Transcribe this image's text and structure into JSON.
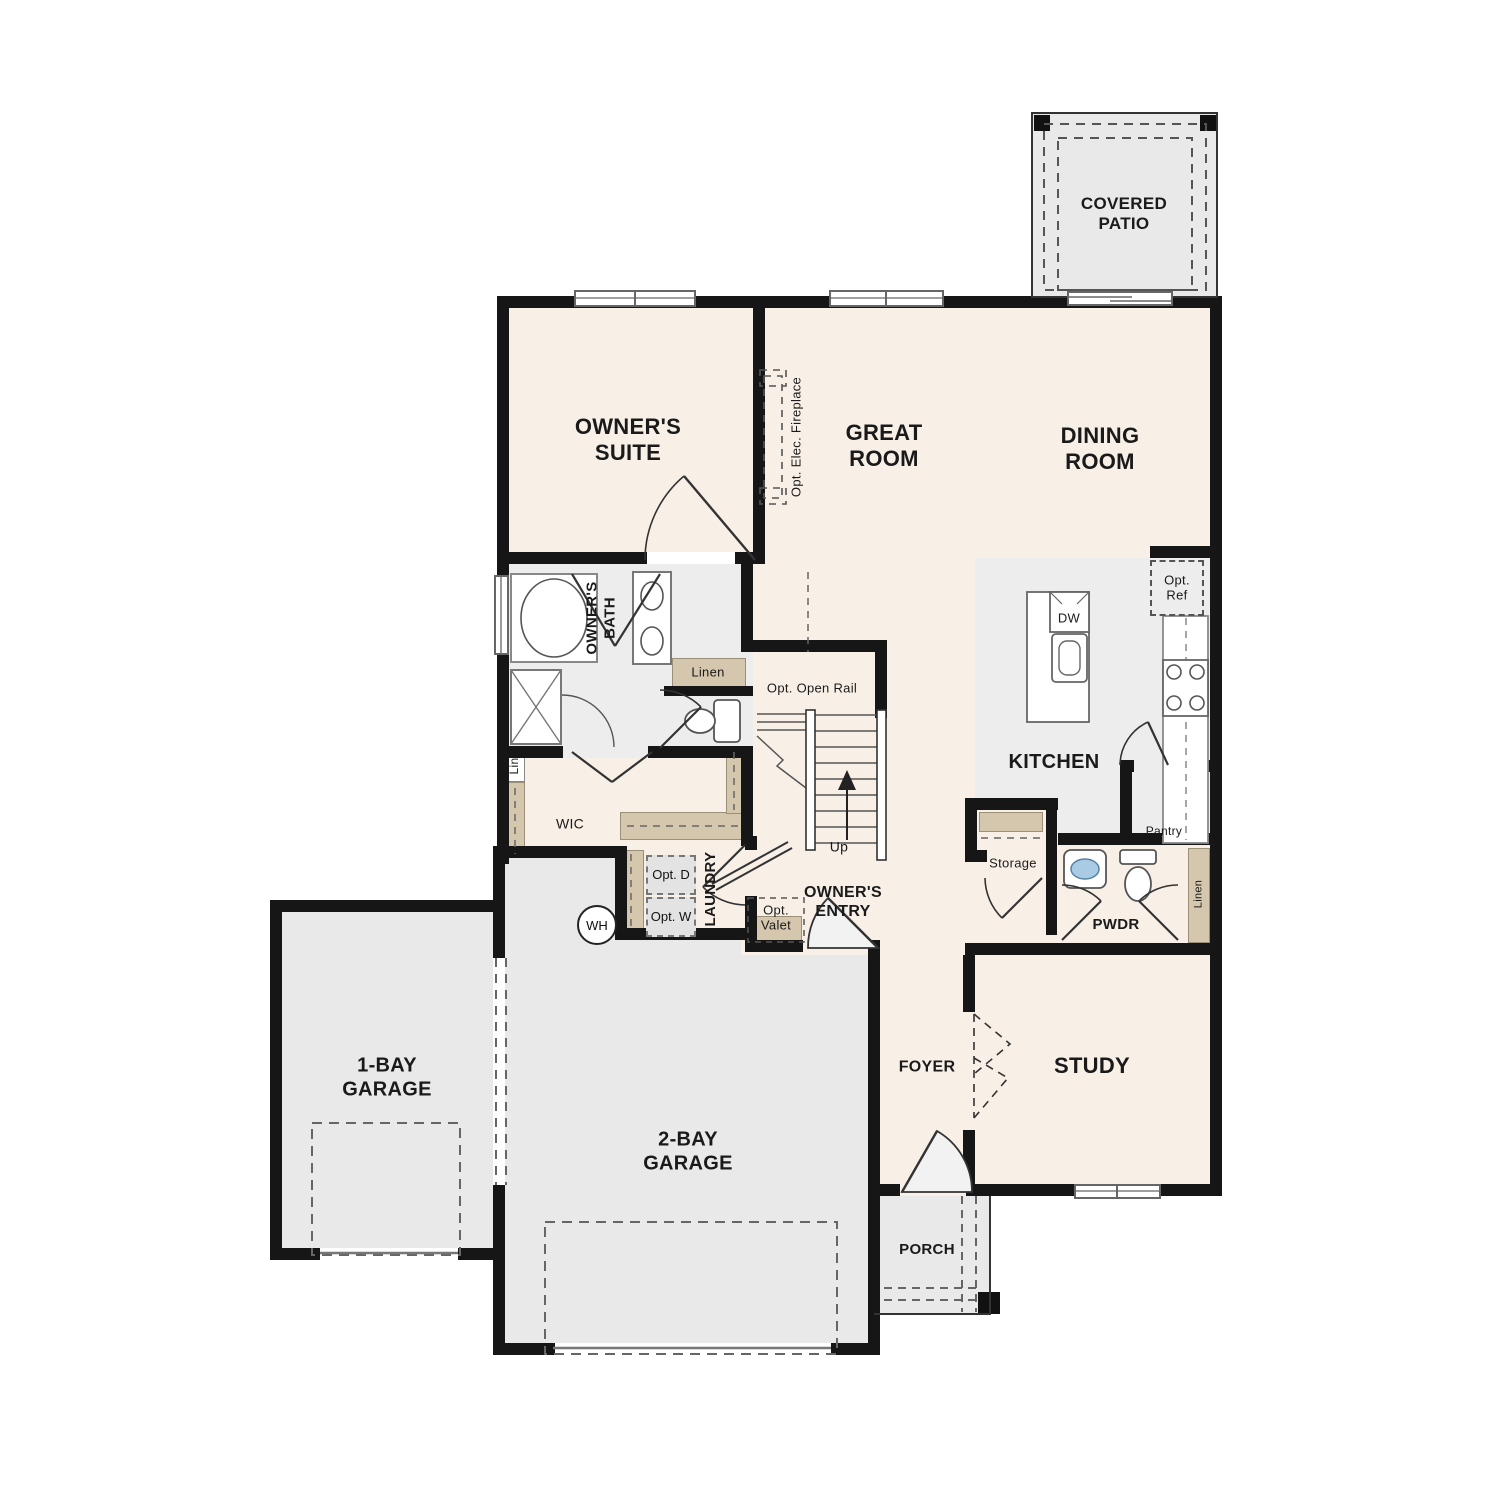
{
  "colors": {
    "room": "#f8f0e7",
    "wet": "#ededed",
    "outdoor": "#e9e9e9",
    "tan": "#d5c7ad",
    "wall": "#161616",
    "ink": "#1a1a1a",
    "sink": "#a9cbe4"
  },
  "rooms": {
    "covered_patio": "COVERED PATIO",
    "owners_suite": "OWNER'S SUITE",
    "great_room": "GREAT ROOM",
    "dining_room": "DINING ROOM",
    "kitchen": "KITCHEN",
    "owners_bath": "OWNER'S BATH",
    "wic": "WIC",
    "laundry": "LAUNDRY",
    "owners_entry": "OWNER'S ENTRY",
    "pwdr": "PWDR",
    "study": "STUDY",
    "foyer": "FOYER",
    "porch": "PORCH",
    "garage_1": "1-BAY GARAGE",
    "garage_2": "2-BAY GARAGE",
    "storage": "Storage",
    "pantry": "Pantry"
  },
  "ann": {
    "fireplace": "Opt. Elec. Fireplace",
    "open_rail": "Opt. Open Rail",
    "up": "Up",
    "linen": "Linen",
    "lin": "Lin",
    "opt_d": "Opt. D",
    "opt_w": "Opt. W",
    "wh": "WH",
    "valet": "Opt. Valet",
    "ref": "Opt. Ref",
    "dw": "DW",
    "linen_hall": "Linen"
  }
}
